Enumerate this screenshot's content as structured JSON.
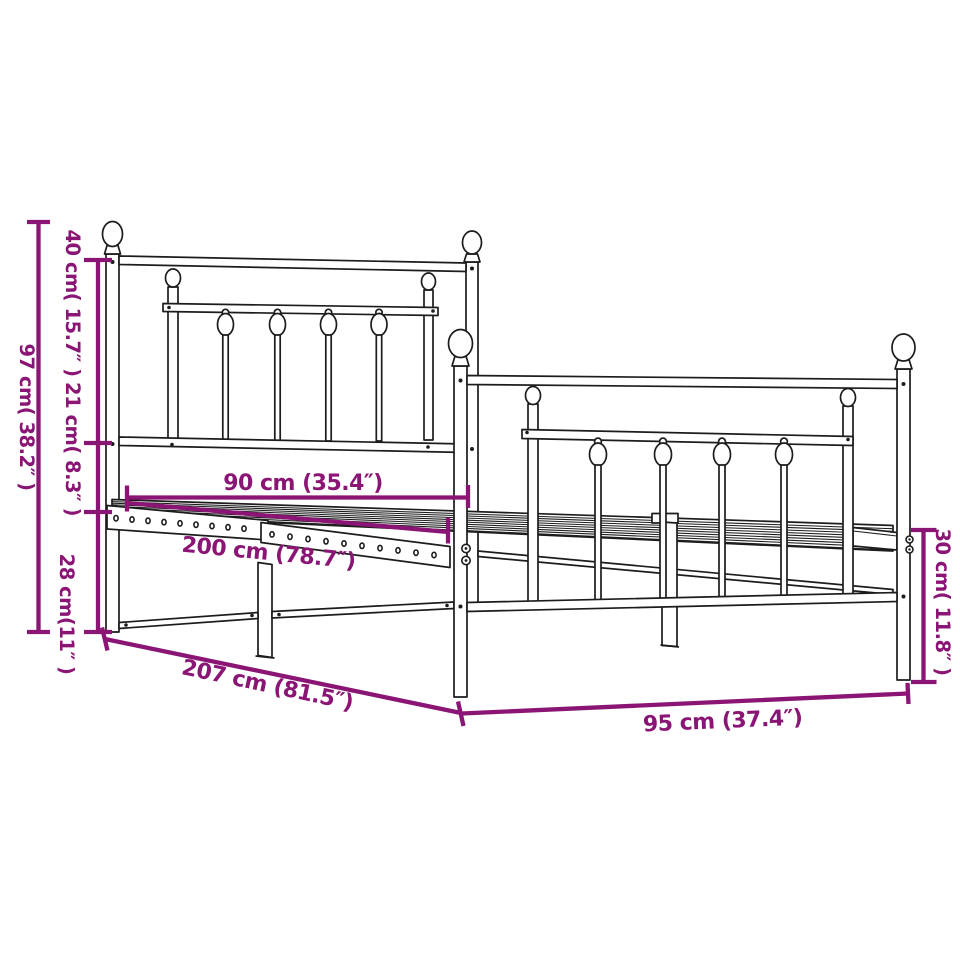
{
  "diagram": {
    "kind": "product dimension diagram",
    "subject": "metal bed frame with headboard and footboard",
    "colors": {
      "dimension_accent": "#8B1574",
      "line_art": "#1C1C1C",
      "background": "#FFFFFF"
    },
    "dimensions": {
      "overall_height": "97 cm( 38.2″ )",
      "headboard_upper_height": "40 cm( 15.7″ )",
      "headboard_lower_height": "21 cm( 8.3″ )",
      "base_height": "28 cm(11″ )",
      "slat_base_width": "90 cm (35.4″)",
      "slat_base_length": "200 cm (78.7″)",
      "overall_length": "207 cm (81.5″)",
      "overall_width": "95 cm (37.4″)",
      "footboard_height": "30 cm( 11.8″ )"
    }
  }
}
